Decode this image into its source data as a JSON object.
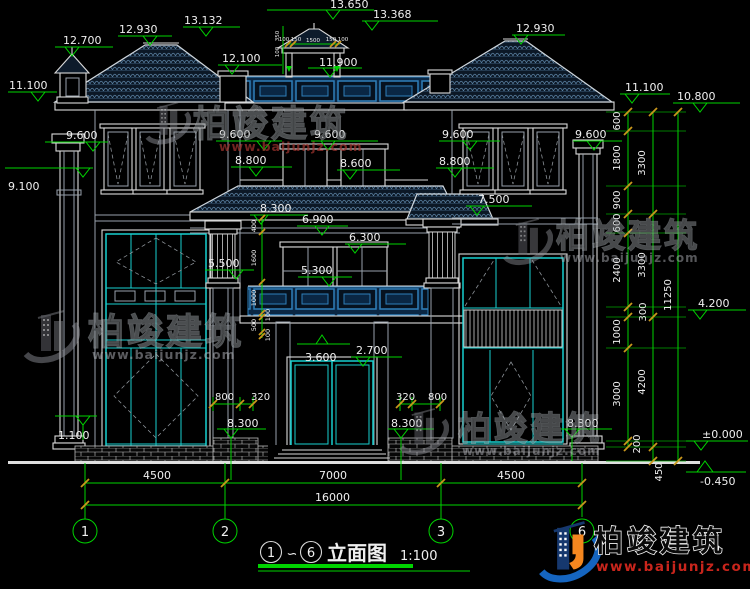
{
  "colors": {
    "background": "#000000",
    "dim_green": "#00d300",
    "window_cyan": "#17cfcf",
    "roof_blue": "#5b82a3",
    "railing_blue": "#2f7fba",
    "tick_orange": "#c9971c",
    "brand_blue": "#1565c0",
    "brand_orange": "#f5871f",
    "url_red": "#c8251c"
  },
  "watermark": {
    "brand": "柏竣建筑",
    "url": "www.baijunjz.com"
  },
  "title_block": {
    "bubble_from": "1",
    "wave": "∽",
    "bubble_to": "6",
    "name": "立面图",
    "scale": "1:100"
  },
  "grid": {
    "bubbles": [
      "1",
      "2",
      "3",
      "6"
    ]
  },
  "dims_bottom": {
    "bay_left": "4500",
    "bay_mid": "7000",
    "bay_right": "4500",
    "total": "16000"
  },
  "levels": {
    "t12700": "12.700",
    "t12930l": "12.930",
    "t13132": "13.132",
    "t13650": "13.650",
    "t13368": "13.368",
    "t12930r": "12.930",
    "t12100": "12.100",
    "t11900": "11.900",
    "t11100l": "11.100",
    "t11100r": "11.100",
    "t10800": "10.800",
    "t9600a": "9.600",
    "t9600b": "9.600",
    "t9600c": "9.600",
    "t9600d": "9.600",
    "t9600e": "9.600",
    "t8800l": "8.800",
    "t8600": "8.600",
    "t8800r": "8.800",
    "t9100": "9.100",
    "t8300aw": "8.300",
    "t6900": "6.900",
    "t7500": "7.500",
    "t6300": "6.300",
    "t5500": "5.500",
    "t5300": "5.300",
    "t4200": "4.200",
    "t3600": "3.600",
    "t2700": "2.700",
    "t1100": "1.100",
    "tzero": "±0.000",
    "tm450": "-0.450",
    "t8300a": "8.300",
    "t8300b": "8.300",
    "t8300c": "8.300"
  },
  "dims_door": {
    "d800l": "800",
    "d320l": "320",
    "d320r": "320",
    "d800r": "800"
  },
  "chain_inner": [
    "600",
    "1800",
    "900",
    "600",
    "2400",
    "300",
    "1000",
    "3000",
    "200"
  ],
  "chain_mid": [
    "3300",
    "3300",
    "4200",
    "450"
  ],
  "chain_total": "11250",
  "chain_left_small": [
    "400",
    "1600",
    "1000",
    "100",
    "500",
    "100"
  ],
  "cupola_dims": {
    "w100a": "100",
    "w150a": "150",
    "w1500": "1500",
    "w150b": "150",
    "w100b": "100",
    "h350": "350",
    "h100": "100"
  }
}
